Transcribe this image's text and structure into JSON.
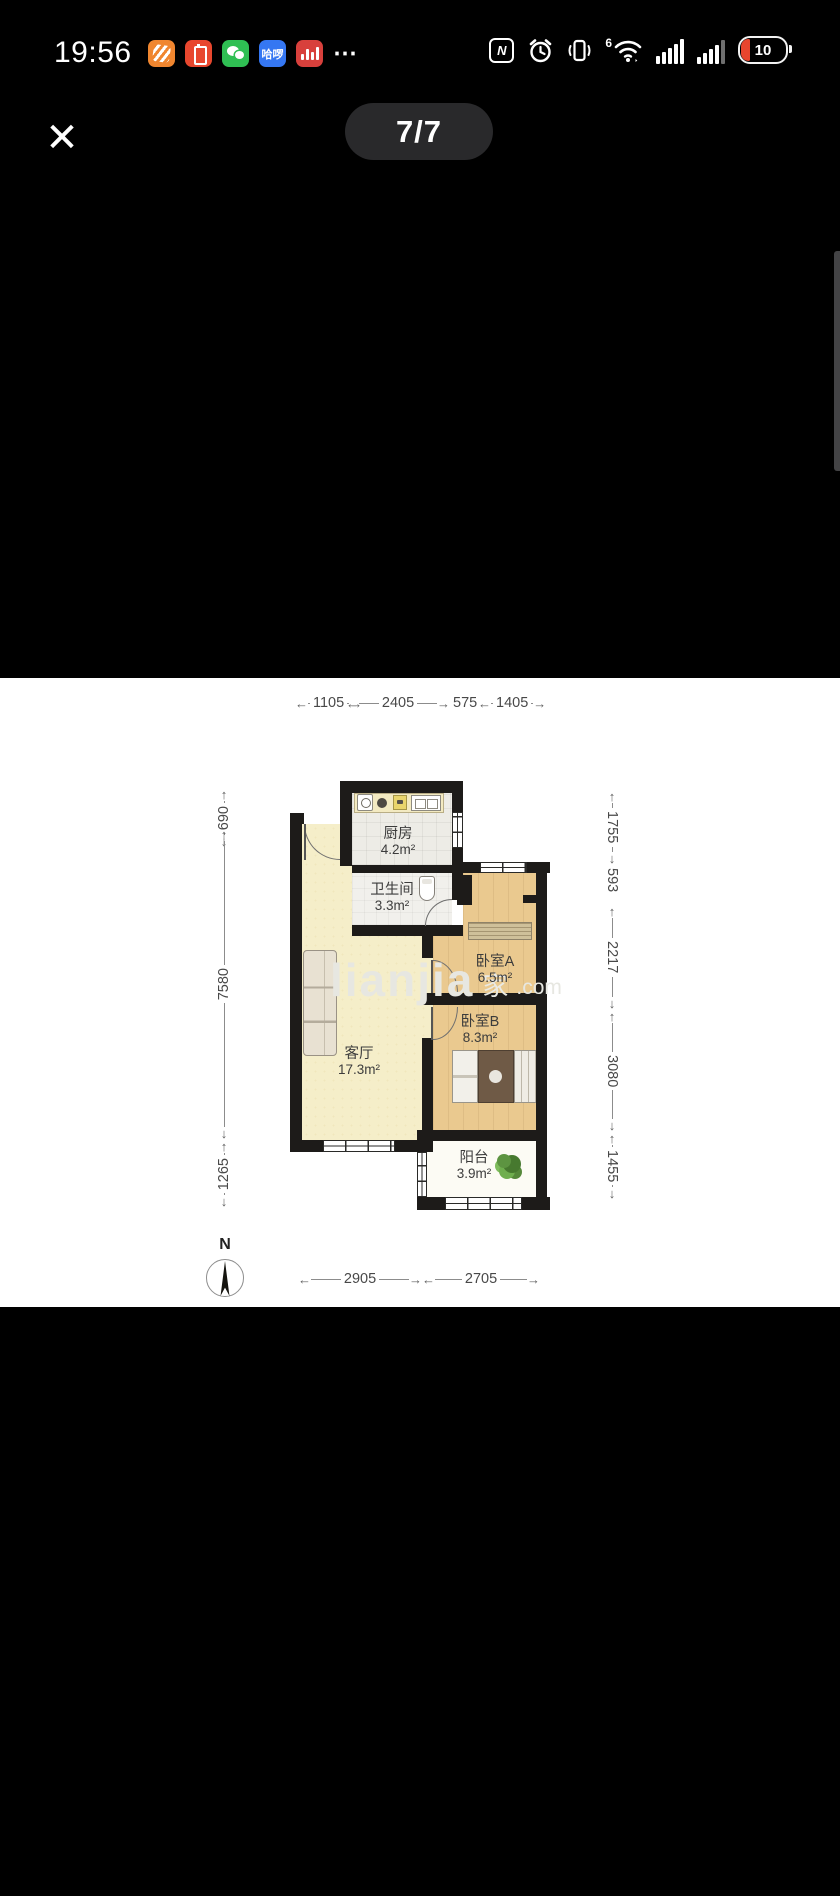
{
  "status_bar": {
    "time": "19:56",
    "more_indicator": "⋯",
    "nfc_label": "N",
    "wifi_generation": "6",
    "battery_percent": "10",
    "app_icons": [
      {
        "name": "keep-app-icon",
        "color": "#f0862f"
      },
      {
        "name": "battery-app-icon",
        "color": "#e8472e"
      },
      {
        "name": "wechat-app-icon",
        "color": "#2fbf53"
      },
      {
        "name": "hello-app-icon",
        "color": "#3577f2",
        "label": "哈啰"
      },
      {
        "name": "media-app-icon",
        "color": "#d8403c"
      }
    ]
  },
  "viewer": {
    "close_glyph": "✕",
    "counter": "7/7"
  },
  "floor_plan": {
    "rooms": {
      "kitchen": {
        "name": "厨房",
        "area": "4.2m²"
      },
      "bathroom": {
        "name": "卫生间",
        "area": "3.3m²"
      },
      "bedroom_a": {
        "name": "卧室A",
        "area": "6.5m²"
      },
      "bedroom_b": {
        "name": "卧室B",
        "area": "8.3m²"
      },
      "living": {
        "name": "客厅",
        "area": "17.3m²"
      },
      "balcony": {
        "name": "阳台",
        "area": "3.9m²"
      }
    },
    "dimensions_mm": {
      "top": [
        "1105",
        "2405",
        "575",
        "1405"
      ],
      "left": [
        "690",
        "7580",
        "1265"
      ],
      "right": [
        "1755",
        "593",
        "2217",
        "3080",
        "1455"
      ],
      "bottom": [
        "2905",
        "2705"
      ]
    },
    "compass_label": "N",
    "watermark": {
      "latin": "lianjia",
      "cjk": "家",
      "tld": ".com"
    },
    "colors": {
      "wall": "#1d1b19",
      "living_floor": "#f5eec9",
      "wood_floor": "#eac98f",
      "kitchen_floor": "#edece6",
      "balcony_floor": "#fcfbf4",
      "counter": "#f3eac1"
    }
  }
}
